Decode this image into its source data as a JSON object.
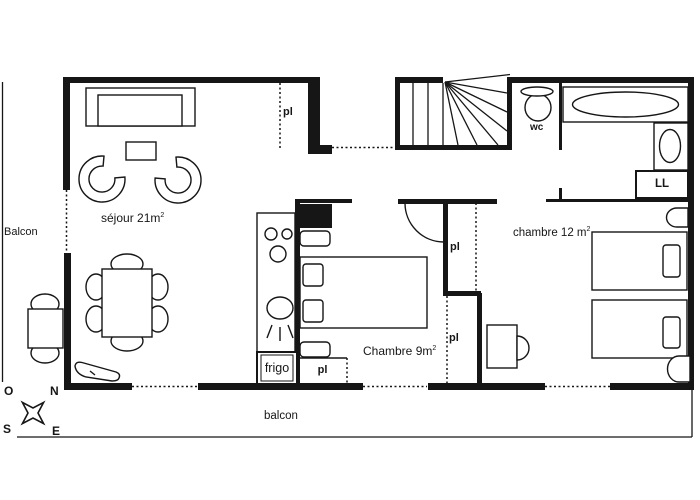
{
  "canvas": {
    "width": 700,
    "height": 500,
    "background": "#ffffff",
    "line_color": "#161616"
  },
  "rooms": {
    "sejour": {
      "label": "séjour 21m",
      "sup": "2"
    },
    "chambre9": {
      "label": "Chambre 9m",
      "sup": "2"
    },
    "chambre12": {
      "label": "chambre 12 m",
      "sup": "2"
    },
    "balcon_left": {
      "label": "Balcon"
    },
    "balcon_bottom": {
      "label": "balcon"
    },
    "wc": {
      "label": "wc"
    }
  },
  "closets": {
    "entry": "pl",
    "chambre9_upper": "pl",
    "chambre9_lower": "pl",
    "kitchen": "pl"
  },
  "appliances": {
    "fridge": "frigo",
    "washing_machine": "LL"
  },
  "compass": {
    "west": "O",
    "north": "N",
    "south": "S",
    "east": "E"
  },
  "furniture_icons": [
    "sofa-icon",
    "coffee-table-icon",
    "armchair-icon",
    "dining-table-icon",
    "chair-icon",
    "balcony-table-icon",
    "bench-icon",
    "kitchen-counter-icon",
    "hotplate-icon",
    "sink-icon",
    "fridge-icon",
    "staircase-icon",
    "toilet-icon",
    "bathtub-icon",
    "washbasin-icon",
    "washing-machine-icon",
    "bed-icon",
    "pillow-icon",
    "nightstand-icon",
    "desk-icon",
    "desk-chair-icon",
    "door-swing-icon",
    "compass-rose-icon",
    "duct-icon"
  ]
}
